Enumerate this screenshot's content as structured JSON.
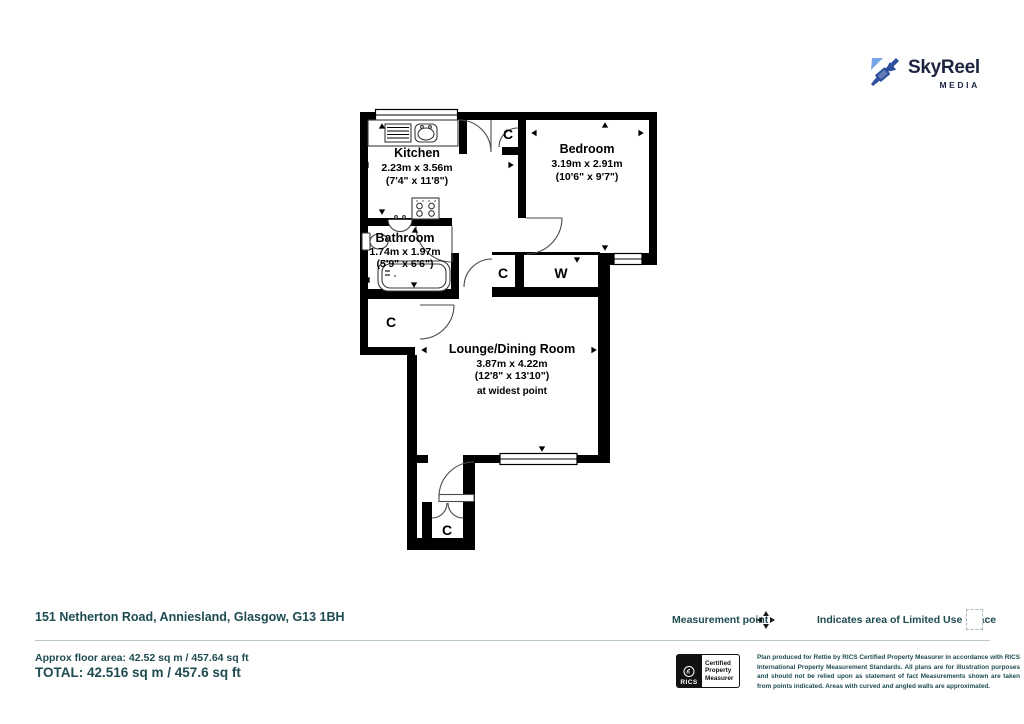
{
  "logo": {
    "brand": "SkyReel",
    "suffix": "MEDIA",
    "icon": "video-camera-icon"
  },
  "floorplan": {
    "rooms": [
      {
        "name": "Kitchen",
        "dim_m": "2.23m x 3.56m",
        "dim_ft": "(7'4\" x 11'8\")"
      },
      {
        "name": "Bedroom",
        "dim_m": "3.19m x 2.91m",
        "dim_ft": "(10'6\" x 9'7\")"
      },
      {
        "name": "Bathroom",
        "dim_m": "1.74m x 1.97m",
        "dim_ft": "(5'9\" x 6'6\")"
      },
      {
        "name": "Lounge/Dining Room",
        "dim_m": "3.87m x 4.22m",
        "dim_ft": "(12'8\" x 13'10\")",
        "note": "at widest point"
      }
    ],
    "closets": {
      "top": "C",
      "hall": "C",
      "wardrobe": "W",
      "store": "C",
      "entrance": "C"
    }
  },
  "footer": {
    "address": "151 Netherton Road, Anniesland, Glasgow, G13 1BH",
    "approx": "Approx floor area: 42.52 sq m / 457.64 sq ft",
    "total": "TOTAL: 42.516 sq m / 457.6 sq ft",
    "legend": {
      "measurement_point": "Measurement point",
      "limited_use": "Indicates area of Limited Use Space"
    },
    "rics": {
      "brand": "RICS",
      "cert_lines": [
        "Certified",
        "Property",
        "Measurer"
      ]
    },
    "disclaimer": "Plan produced for Rettie by RICS Certified Property Measurer in accordance with RICS International Property Measurement Standards.  All plans are for illustration purposes and should not be relied upon as statement of fact Measurements shown are taken from points indicated. Areas with curved and angled walls are approximated."
  },
  "colors": {
    "footer_text": "#1e4b50",
    "wall": "#000000",
    "logo_navy": "#1c2440",
    "logo_blue": "#2e4f9e",
    "logo_light_blue": "#7aa5e6",
    "divider": "#b9c7ca"
  }
}
